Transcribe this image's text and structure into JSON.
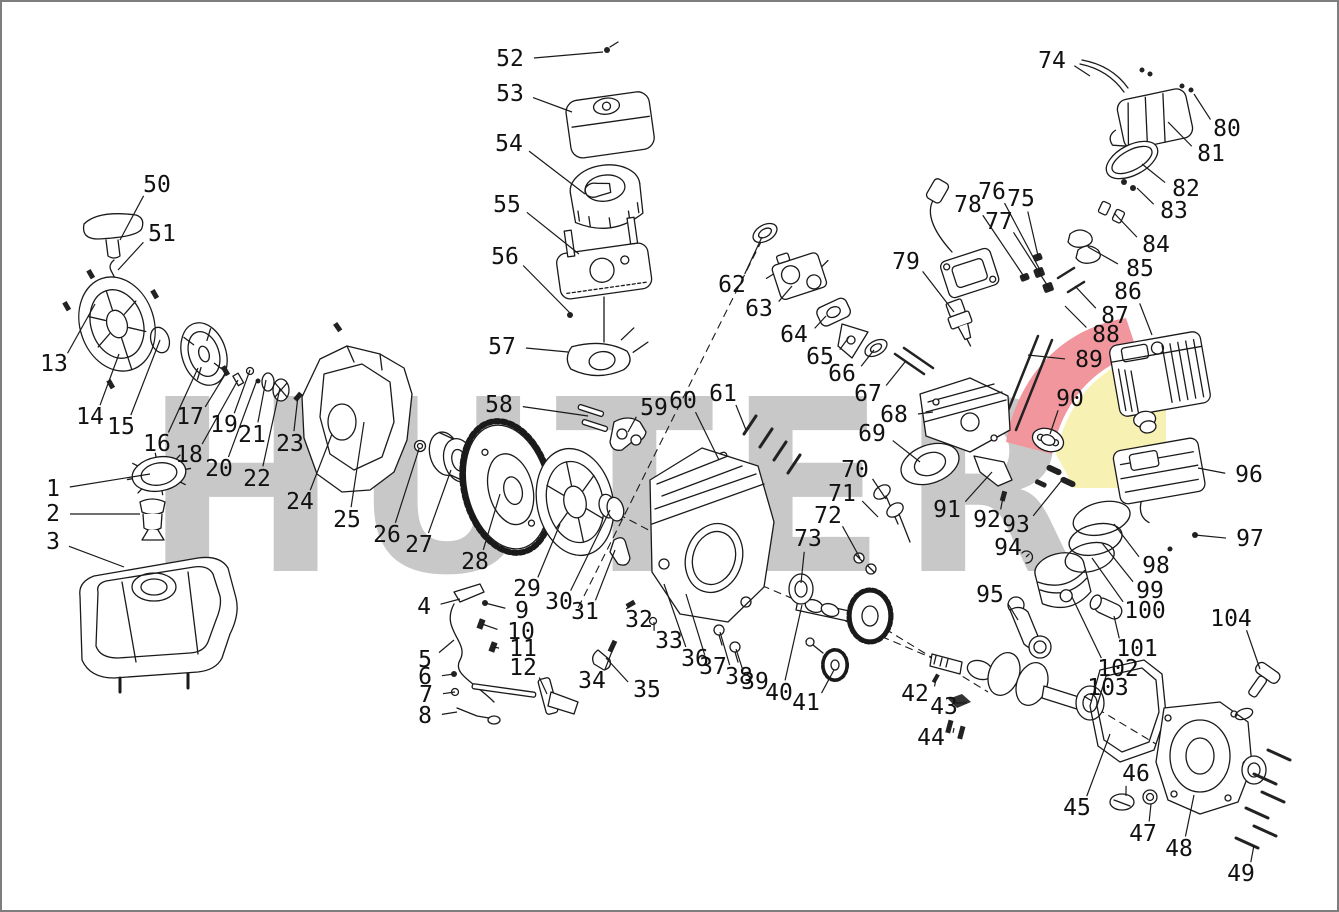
{
  "watermark": {
    "text": "HUTER",
    "gray": "#c8c8c8",
    "flame_red": "#f0969c",
    "flame_yellow": "#f8f1b4"
  },
  "frame_color": "#7e7e7e",
  "diagram": {
    "type": "exploded-parts-diagram",
    "subject": "gasoline engine spare parts",
    "line_color": "#1a1a1a",
    "rope_guide_highlight": "#f0a030",
    "labels": [
      {
        "n": "1",
        "x": 51,
        "y": 487,
        "tx": 148,
        "ty": 472
      },
      {
        "n": "2",
        "x": 51,
        "y": 512,
        "tx": 138,
        "ty": 512
      },
      {
        "n": "3",
        "x": 51,
        "y": 540,
        "tx": 122,
        "ty": 565
      },
      {
        "n": "4",
        "x": 422,
        "y": 605,
        "tx": 458,
        "ty": 597
      },
      {
        "n": "5",
        "x": 423,
        "y": 658,
        "tx": 452,
        "ty": 638
      },
      {
        "n": "6",
        "x": 423,
        "y": 675,
        "tx": 452,
        "ty": 672
      },
      {
        "n": "7",
        "x": 424,
        "y": 693,
        "tx": 453,
        "ty": 690
      },
      {
        "n": "8",
        "x": 423,
        "y": 714,
        "tx": 455,
        "ty": 710
      },
      {
        "n": "9",
        "x": 520,
        "y": 609,
        "tx": 483,
        "ty": 601
      },
      {
        "n": "10",
        "x": 519,
        "y": 630,
        "tx": 480,
        "ty": 622
      },
      {
        "n": "11",
        "x": 521,
        "y": 647,
        "tx": 492,
        "ty": 645
      },
      {
        "n": "12",
        "x": 521,
        "y": 666,
        "tx": 545,
        "ty": 692
      },
      {
        "n": "13",
        "x": 52,
        "y": 362,
        "tx": 93,
        "ty": 302
      },
      {
        "n": "14",
        "x": 88,
        "y": 415,
        "tx": 117,
        "ty": 352
      },
      {
        "n": "15",
        "x": 119,
        "y": 425,
        "tx": 158,
        "ty": 338
      },
      {
        "n": "16",
        "x": 155,
        "y": 442,
        "tx": 196,
        "ty": 366
      },
      {
        "n": "17",
        "x": 188,
        "y": 415,
        "tx": 224,
        "ty": 371
      },
      {
        "n": "18",
        "x": 187,
        "y": 453,
        "tx": 236,
        "ty": 378
      },
      {
        "n": "19",
        "x": 222,
        "y": 423,
        "tx": 248,
        "ty": 368
      },
      {
        "n": "20",
        "x": 217,
        "y": 467,
        "tx": 255,
        "ty": 378
      },
      {
        "n": "21",
        "x": 250,
        "y": 433,
        "tx": 264,
        "ty": 378
      },
      {
        "n": "22",
        "x": 255,
        "y": 477,
        "tx": 278,
        "ty": 386
      },
      {
        "n": "23",
        "x": 288,
        "y": 442,
        "tx": 296,
        "ty": 394
      },
      {
        "n": "24",
        "x": 298,
        "y": 500,
        "tx": 330,
        "ty": 432
      },
      {
        "n": "25",
        "x": 345,
        "y": 518,
        "tx": 362,
        "ty": 420
      },
      {
        "n": "26",
        "x": 385,
        "y": 533,
        "tx": 417,
        "ty": 447
      },
      {
        "n": "27",
        "x": 417,
        "y": 543,
        "tx": 449,
        "ty": 468
      },
      {
        "n": "28",
        "x": 473,
        "y": 560,
        "tx": 498,
        "ty": 492
      },
      {
        "n": "29",
        "x": 525,
        "y": 587,
        "tx": 558,
        "ty": 522
      },
      {
        "n": "30",
        "x": 557,
        "y": 600,
        "tx": 608,
        "ty": 508
      },
      {
        "n": "31",
        "x": 583,
        "y": 610,
        "tx": 613,
        "ty": 548
      },
      {
        "n": "32",
        "x": 637,
        "y": 618,
        "tx": 628,
        "ty": 604
      },
      {
        "n": "33",
        "x": 667,
        "y": 639,
        "tx": 652,
        "ty": 620
      },
      {
        "n": "34",
        "x": 590,
        "y": 679,
        "tx": 612,
        "ty": 644
      },
      {
        "n": "35",
        "x": 645,
        "y": 688,
        "tx": 604,
        "ty": 656
      },
      {
        "n": "36",
        "x": 693,
        "y": 657,
        "tx": 662,
        "ty": 582
      },
      {
        "n": "37",
        "x": 711,
        "y": 665,
        "tx": 684,
        "ty": 592
      },
      {
        "n": "38",
        "x": 737,
        "y": 675,
        "tx": 718,
        "ty": 630
      },
      {
        "n": "39",
        "x": 753,
        "y": 680,
        "tx": 734,
        "ty": 647
      },
      {
        "n": "40",
        "x": 777,
        "y": 691,
        "tx": 800,
        "ty": 603
      },
      {
        "n": "41",
        "x": 804,
        "y": 701,
        "tx": 832,
        "ty": 668
      },
      {
        "n": "42",
        "x": 913,
        "y": 692,
        "tx": 934,
        "ty": 677
      },
      {
        "n": "43",
        "x": 942,
        "y": 705,
        "tx": 954,
        "ty": 701
      },
      {
        "n": "44",
        "x": 929,
        "y": 736,
        "tx": 952,
        "ty": 726
      },
      {
        "n": "45",
        "x": 1075,
        "y": 806,
        "tx": 1108,
        "ty": 732
      },
      {
        "n": "46",
        "x": 1134,
        "y": 772,
        "tx": 1124,
        "ty": 794
      },
      {
        "n": "47",
        "x": 1141,
        "y": 832,
        "tx": 1149,
        "ty": 802
      },
      {
        "n": "48",
        "x": 1177,
        "y": 847,
        "tx": 1192,
        "ty": 793
      },
      {
        "n": "49",
        "x": 1239,
        "y": 872,
        "tx": 1252,
        "ty": 843
      },
      {
        "n": "50",
        "x": 155,
        "y": 183,
        "tx": 118,
        "ty": 238
      },
      {
        "n": "51",
        "x": 160,
        "y": 232,
        "tx": 116,
        "ty": 268
      },
      {
        "n": "52",
        "x": 508,
        "y": 57,
        "tx": 601,
        "ty": 50
      },
      {
        "n": "53",
        "x": 508,
        "y": 92,
        "tx": 570,
        "ty": 110
      },
      {
        "n": "54",
        "x": 507,
        "y": 142,
        "tx": 583,
        "ty": 192
      },
      {
        "n": "55",
        "x": 505,
        "y": 203,
        "tx": 577,
        "ty": 252
      },
      {
        "n": "56",
        "x": 503,
        "y": 255,
        "tx": 568,
        "ty": 311
      },
      {
        "n": "57",
        "x": 500,
        "y": 345,
        "tx": 566,
        "ty": 350
      },
      {
        "n": "58",
        "x": 497,
        "y": 403,
        "tx": 586,
        "ty": 414
      },
      {
        "n": "59",
        "x": 652,
        "y": 406,
        "tx": 626,
        "ty": 430
      },
      {
        "n": "60",
        "x": 681,
        "y": 399,
        "tx": 717,
        "ty": 458
      },
      {
        "n": "61",
        "x": 721,
        "y": 392,
        "tx": 744,
        "ty": 428
      },
      {
        "n": "62",
        "x": 730,
        "y": 283,
        "tx": 760,
        "ty": 235
      },
      {
        "n": "63",
        "x": 757,
        "y": 307,
        "tx": 790,
        "ty": 284
      },
      {
        "n": "64",
        "x": 792,
        "y": 333,
        "tx": 824,
        "ty": 314
      },
      {
        "n": "65",
        "x": 818,
        "y": 355,
        "tx": 847,
        "ty": 335
      },
      {
        "n": "66",
        "x": 840,
        "y": 372,
        "tx": 872,
        "ty": 348
      },
      {
        "n": "67",
        "x": 866,
        "y": 392,
        "tx": 903,
        "ty": 360
      },
      {
        "n": "68",
        "x": 892,
        "y": 413,
        "tx": 931,
        "ty": 410
      },
      {
        "n": "69",
        "x": 870,
        "y": 432,
        "tx": 918,
        "ty": 460
      },
      {
        "n": "70",
        "x": 853,
        "y": 468,
        "tx": 884,
        "ty": 497
      },
      {
        "n": "71",
        "x": 840,
        "y": 492,
        "tx": 876,
        "ty": 515
      },
      {
        "n": "72",
        "x": 826,
        "y": 514,
        "tx": 858,
        "ty": 556
      },
      {
        "n": "73",
        "x": 806,
        "y": 537,
        "tx": 799,
        "ty": 581
      },
      {
        "n": "74",
        "x": 1050,
        "y": 59,
        "tx": 1088,
        "ty": 74
      },
      {
        "n": "75",
        "x": 1019,
        "y": 197,
        "tx": 1037,
        "ty": 258
      },
      {
        "n": "76",
        "x": 990,
        "y": 190,
        "tx": 1039,
        "ty": 270
      },
      {
        "n": "77",
        "x": 997,
        "y": 220,
        "tx": 1047,
        "ty": 286
      },
      {
        "n": "78",
        "x": 966,
        "y": 203,
        "tx": 1023,
        "ty": 276
      },
      {
        "n": "79",
        "x": 904,
        "y": 260,
        "tx": 952,
        "ty": 310
      },
      {
        "n": "80",
        "x": 1225,
        "y": 127,
        "tx": 1192,
        "ty": 92
      },
      {
        "n": "81",
        "x": 1209,
        "y": 152,
        "tx": 1166,
        "ty": 120
      },
      {
        "n": "82",
        "x": 1184,
        "y": 187,
        "tx": 1140,
        "ty": 162
      },
      {
        "n": "83",
        "x": 1172,
        "y": 209,
        "tx": 1135,
        "ty": 186
      },
      {
        "n": "84",
        "x": 1154,
        "y": 243,
        "tx": 1112,
        "ty": 211
      },
      {
        "n": "85",
        "x": 1138,
        "y": 267,
        "tx": 1086,
        "ty": 245
      },
      {
        "n": "86",
        "x": 1126,
        "y": 290,
        "tx": 1150,
        "ty": 333
      },
      {
        "n": "87",
        "x": 1113,
        "y": 314,
        "tx": 1073,
        "ty": 284
      },
      {
        "n": "88",
        "x": 1104,
        "y": 333,
        "tx": 1063,
        "ty": 304
      },
      {
        "n": "89",
        "x": 1087,
        "y": 358,
        "tx": 1026,
        "ty": 353
      },
      {
        "n": "90",
        "x": 1068,
        "y": 397,
        "tx": 1048,
        "ty": 432
      },
      {
        "n": "91",
        "x": 945,
        "y": 508,
        "tx": 990,
        "ty": 470
      },
      {
        "n": "92",
        "x": 985,
        "y": 518,
        "tx": 1001,
        "ty": 495
      },
      {
        "n": "93",
        "x": 1014,
        "y": 523,
        "tx": 1060,
        "ty": 478
      },
      {
        "n": "94",
        "x": 1006,
        "y": 546,
        "tx": 1024,
        "ty": 555
      },
      {
        "n": "95",
        "x": 988,
        "y": 593,
        "tx": 1016,
        "ty": 618
      },
      {
        "n": "96",
        "x": 1247,
        "y": 473,
        "tx": 1196,
        "ty": 466
      },
      {
        "n": "97",
        "x": 1248,
        "y": 537,
        "tx": 1193,
        "ty": 533
      },
      {
        "n": "98",
        "x": 1154,
        "y": 564,
        "tx": 1112,
        "ty": 522
      },
      {
        "n": "99",
        "x": 1148,
        "y": 589,
        "tx": 1100,
        "ty": 541
      },
      {
        "n": "100",
        "x": 1143,
        "y": 609,
        "tx": 1090,
        "ty": 556
      },
      {
        "n": "101",
        "x": 1135,
        "y": 647,
        "tx": 1112,
        "ty": 614
      },
      {
        "n": "102",
        "x": 1116,
        "y": 667,
        "tx": 1070,
        "ty": 595
      },
      {
        "n": "103",
        "x": 1106,
        "y": 686,
        "tx": 1090,
        "ty": 699
      },
      {
        "n": "104",
        "x": 1229,
        "y": 617,
        "tx": 1258,
        "ty": 667
      }
    ]
  }
}
